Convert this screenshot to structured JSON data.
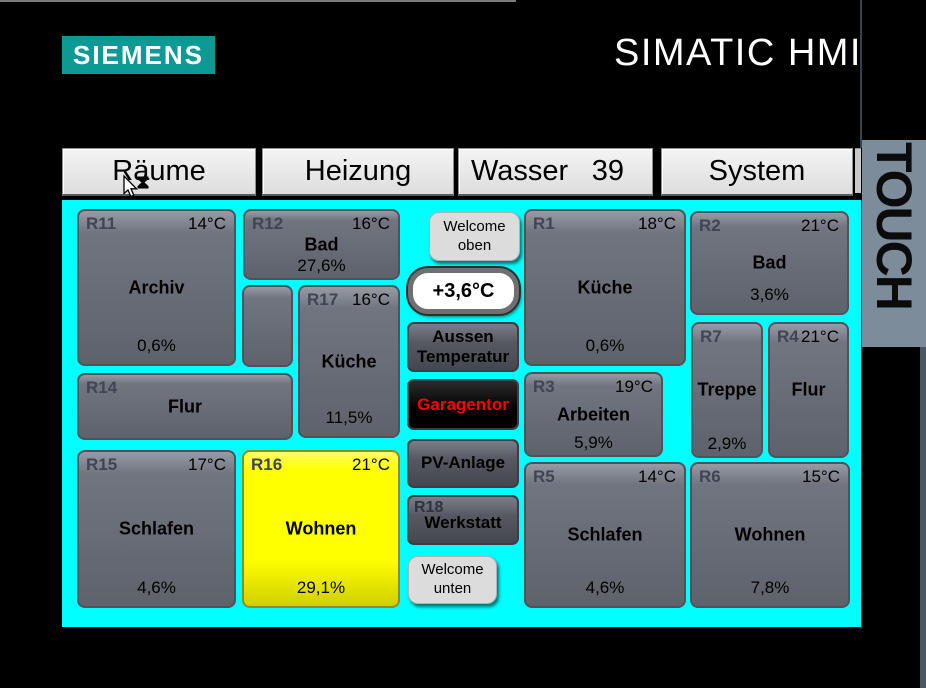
{
  "brand": {
    "logo": "SIEMENS",
    "product": "SIMATIC HMI"
  },
  "bezel": {
    "label": "TOUCH"
  },
  "colors": {
    "panel_background": "#00ffff",
    "room_highlight": "#ffff00",
    "alert_text": "#ff0000",
    "brand_teal": "#0e9a94"
  },
  "tabs": {
    "raeume": {
      "label": "Räume"
    },
    "heizung": {
      "label": "Heizung"
    },
    "wasser": {
      "label": "Wasser",
      "value": "39"
    },
    "system": {
      "label": "System"
    }
  },
  "rooms": {
    "r11": {
      "id": "R11",
      "temp": "14°C",
      "name": "Archiv",
      "pct": "0,6%"
    },
    "r12": {
      "id": "R12",
      "temp": "16°C",
      "name": "Bad",
      "pct": "27,6%"
    },
    "r17": {
      "id": "R17",
      "temp": "16°C",
      "name": "Küche",
      "pct": "11,5%"
    },
    "r14": {
      "id": "R14",
      "name": "Flur"
    },
    "r15": {
      "id": "R15",
      "temp": "17°C",
      "name": "Schlafen",
      "pct": "4,6%"
    },
    "r16": {
      "id": "R16",
      "temp": "21°C",
      "name": "Wohnen",
      "pct": "29,1%"
    },
    "r1": {
      "id": "R1",
      "temp": "18°C",
      "name": "Küche",
      "pct": "0,6%"
    },
    "r2": {
      "id": "R2",
      "temp": "21°C",
      "name": "Bad",
      "pct": "3,6%"
    },
    "r3": {
      "id": "R3",
      "temp": "19°C",
      "name": "Arbeiten",
      "pct": "5,9%"
    },
    "r7": {
      "id": "R7",
      "name": "Treppe",
      "pct": "2,9%"
    },
    "r4": {
      "id": "R4",
      "temp": "21°C",
      "name": "Flur"
    },
    "r5": {
      "id": "R5",
      "temp": "14°C",
      "name": "Schlafen",
      "pct": "4,6%"
    },
    "r6": {
      "id": "R6",
      "temp": "15°C",
      "name": "Wohnen",
      "pct": "7,8%"
    }
  },
  "controls": {
    "welcome_top": {
      "line1": "Welcome",
      "line2": "oben"
    },
    "outside_temp": {
      "value": "+3,6°C",
      "label_line1": "Aussen",
      "label_line2": "Temperatur"
    },
    "garage": {
      "label": "Garagentor"
    },
    "pv": {
      "label": "PV-Anlage"
    },
    "werkstatt": {
      "id": "R18",
      "label": "Werkstatt"
    },
    "welcome_bottom": {
      "line1": "Welcome",
      "line2": "unten"
    }
  }
}
